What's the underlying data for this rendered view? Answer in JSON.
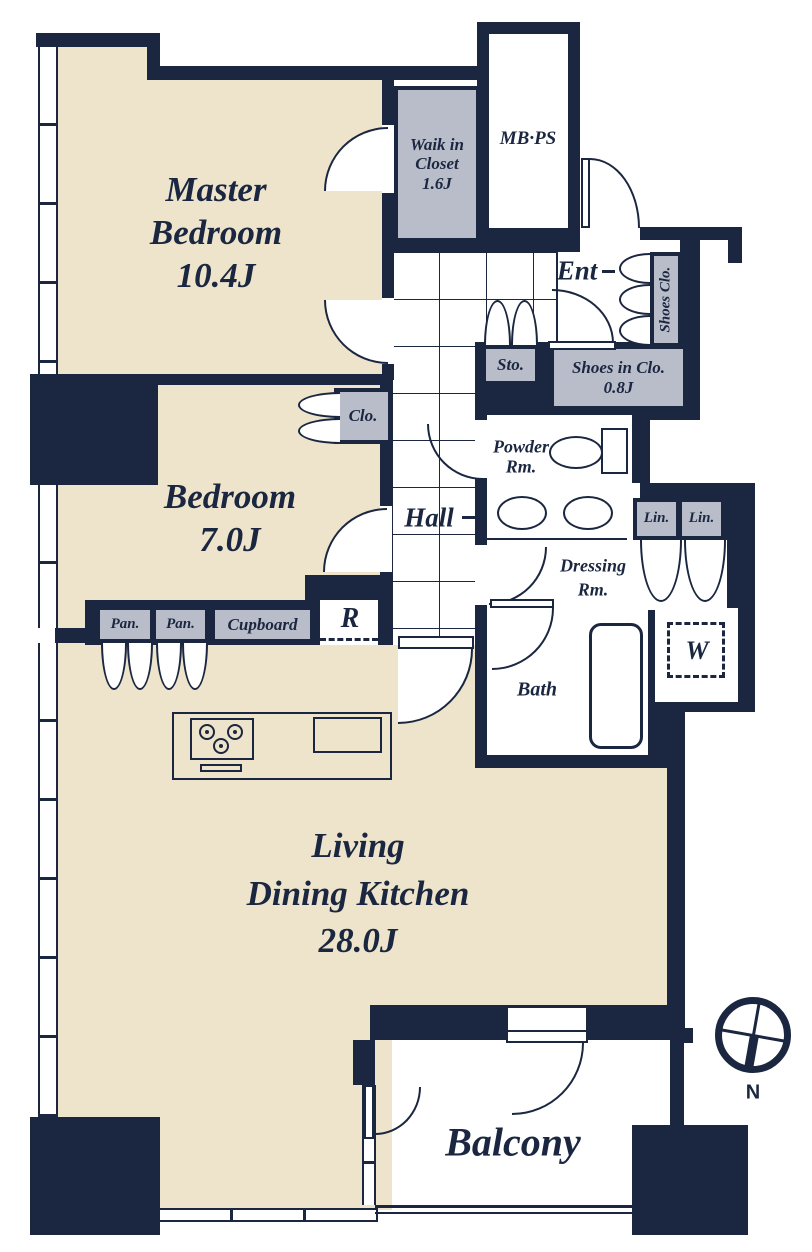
{
  "colors": {
    "navy": "#1b2740",
    "beige": "#ede4cb",
    "gray": "#b9bdca"
  },
  "labels": {
    "master_bedroom": {
      "l1": "Master",
      "l2": "Bedroom",
      "size": "10.4J"
    },
    "bedroom": {
      "l1": "Bedroom",
      "size": "7.0J"
    },
    "ldk": {
      "l1": "Living",
      "l2": "Dining Kitchen",
      "size": "28.0J"
    },
    "balcony": "Balcony",
    "hall": "Hall",
    "ent": "Ent",
    "walk_in_closet": {
      "l1": "Waik in",
      "l2": "Closet",
      "size": "1.6J"
    },
    "mb_ps": "MB·PS",
    "shoes_clo": "Shoes Clo.",
    "sto": "Sto.",
    "shoes_in_clo": {
      "l1": "Shoes in Clo.",
      "size": "0.8J"
    },
    "clo": "Clo.",
    "powder_rm": {
      "l1": "Powder",
      "l2": "Rm."
    },
    "dressing_rm": {
      "l1": "Dressing",
      "l2": "Rm."
    },
    "lin_1": "Lin.",
    "lin_2": "Lin.",
    "bath": "Bath",
    "washer": "W",
    "pan_1": "Pan.",
    "pan_2": "Pan.",
    "cupboard": "Cupboard",
    "fridge": "R",
    "compass_north": "N"
  }
}
